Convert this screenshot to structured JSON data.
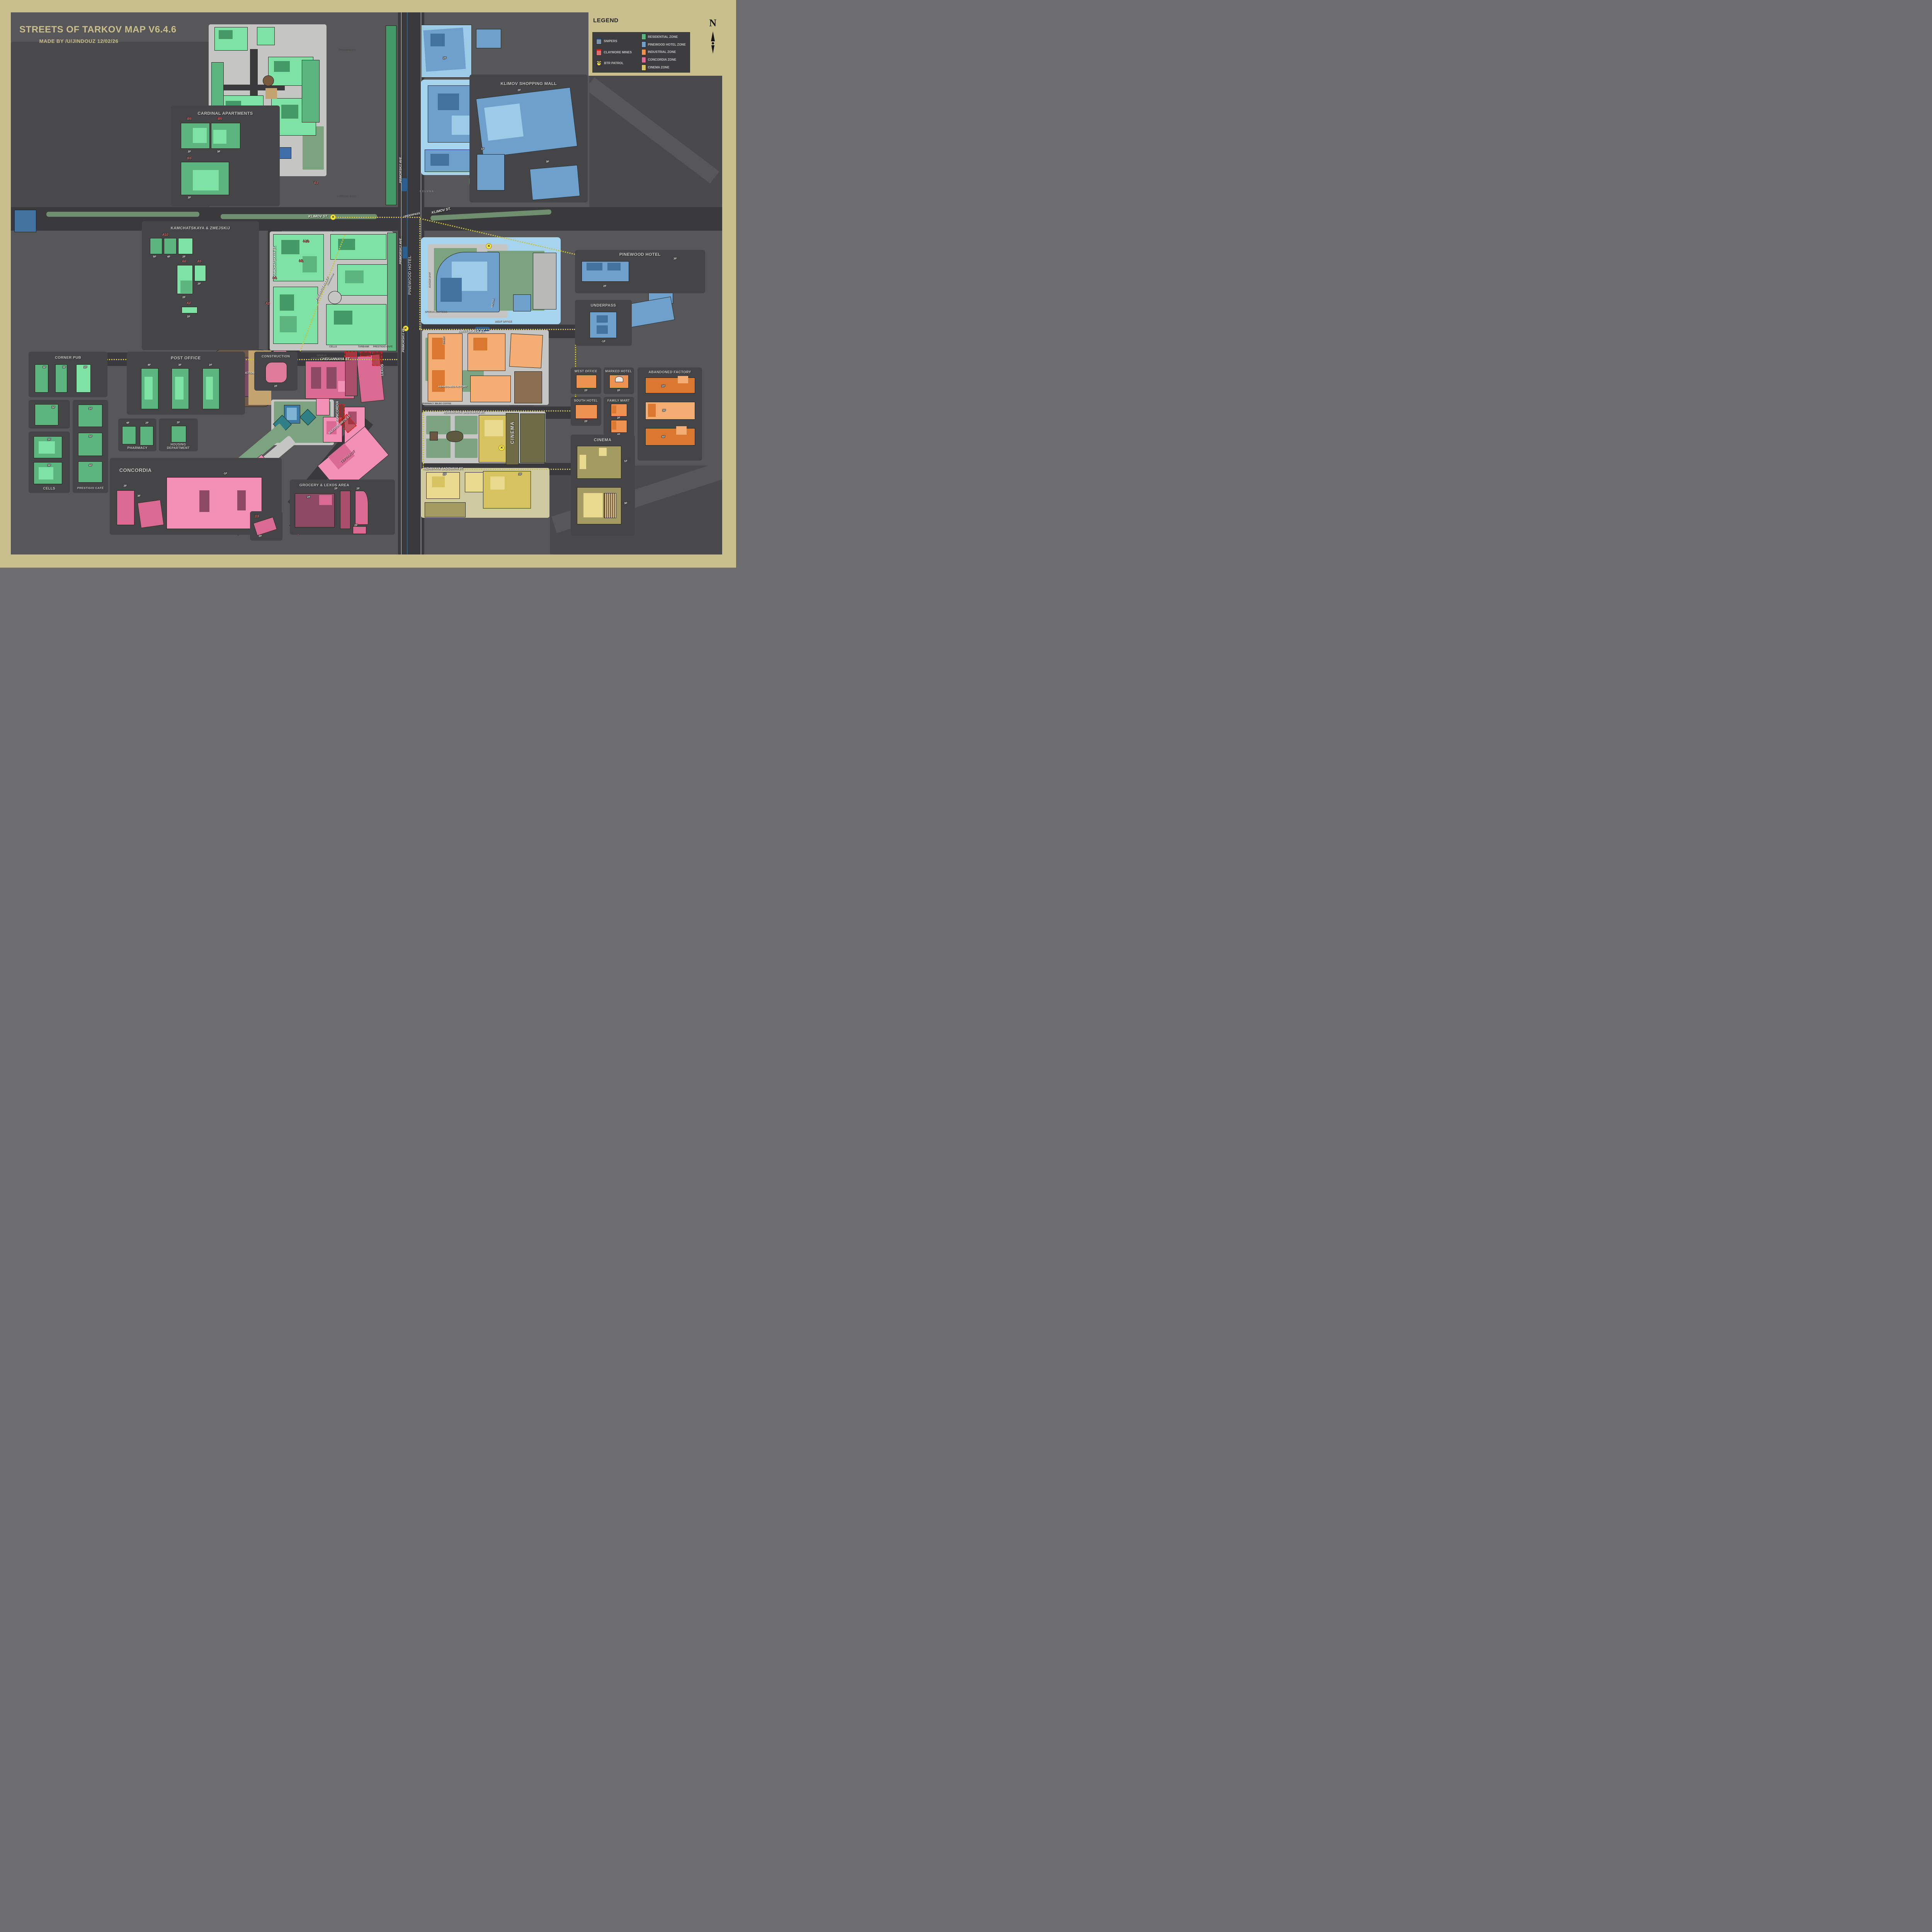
{
  "title": {
    "line1": "STREETS OF TARKOV MAP V6.4.6",
    "line2": "MADE BY /U/JINDOUZ 12/02/26"
  },
  "legend": {
    "title": "LEGEND",
    "markers": [
      {
        "icon": "snipers-icon",
        "label": "SNIPERS"
      },
      {
        "icon": "claymore-icon",
        "label": "CLAYMORE MINES"
      },
      {
        "icon": "btr-icon",
        "label": "BTR PATROL"
      }
    ],
    "zones": [
      {
        "label": "RESIDENTIAL ZONE",
        "color": "#57b57d"
      },
      {
        "label": "PINEWOOD HOTEL ZONE",
        "color": "#6f9fcb"
      },
      {
        "label": "INDUSTRIAL ZONE",
        "color": "#ed9250"
      },
      {
        "label": "CONCORDIA ZONE",
        "color": "#d96a92"
      },
      {
        "label": "CINEMA ZONE",
        "color": "#d6c25e"
      }
    ]
  },
  "compass": {
    "label": "N"
  },
  "streets": {
    "klimov": "KLIMOV ST.",
    "primorskij": "PRIMORSKIJ AVE.",
    "primorskij49": "PRIMORSKIJ 49",
    "nikitskaya": "NIKITSKAYA ST.",
    "chekannaya": "CHEKANNAYA ST.",
    "verhnyaya": "VERHNYAYA SADOVAYA ST.",
    "nizhnyaya": "NIZHNYAYA SADOVAYA ST.",
    "razvedchikov": "RAZVEDCHIKOV ST.",
    "kamchatskaya": "KAMCHATSKAYA ST.",
    "zmejskij": "ZMEJSKIJ ALLEY",
    "underpass": "UNDERPASS"
  },
  "map_labels": {
    "pharmacy3": "PHARMACY 3",
    "cardinal_apartments": "CARDINAL APARTMENTS",
    "cardinal_bank": "CARDINAL BANK",
    "lerm_expo": "LERM Expo",
    "klimov_mall": "KLIMOV SHOPPING MALL",
    "beluga": "BELUGA",
    "pinewood_hotel": "PINEWOOD HOTEL",
    "burger_spot": "BURGER SPOT",
    "sparja_express": "SPARJA EXPRESS",
    "nikita": "NIKITA",
    "west_office": "WEST OFFICE",
    "diner": "DINER",
    "abandoned_factory": "ABANDONED FACTORY",
    "pharmacy2": "PHARMACY 2",
    "bilbo_coffee": "BILBO COFFEE",
    "corner_restaurant": "CORNER RESTAURANT",
    "cinema": "CINEMA",
    "sparja_grocery": "SPARJA\nGROCERY STORE",
    "construction": "CONSTRUCTION",
    "concordia": "CONCORDIA",
    "lexos": "LEXOS",
    "terrakot": "ТЕРРАКОТ",
    "cells": "CELLS",
    "tarbank": "TARBANK",
    "prestigio_cafe": "PRESTIGIO CAFÉ",
    "corner_pub": "CORNER PUB"
  },
  "codes": {
    "b3": "B3",
    "a10": "A10",
    "a6": "A6",
    "a5": "A5",
    "a2": "A2",
    "d3": "D3"
  },
  "map_floors": [
    "2F",
    "2F",
    "2F"
  ],
  "panels": {
    "klimov_mall": {
      "title": "KLIMOV SHOPPING MALL",
      "floors": [
        "2F",
        "1F",
        "3F"
      ]
    },
    "cardinal": {
      "title": "CARDINAL APARTMENTS",
      "codes": [
        "B5",
        "B5",
        "B3"
      ],
      "floors": [
        "2F",
        "3F",
        "2F"
      ]
    },
    "kamchatskaya": {
      "title": "KAMCHATSKAYA & ZMEJSKIJ",
      "codes": [
        "A10",
        "A6",
        "A5",
        "A2"
      ],
      "floors": [
        "5F",
        "4F",
        "2F",
        "2F",
        "2F",
        "2F"
      ]
    },
    "corner_pub": {
      "title": "CORNER PUB",
      "floors": [
        "4F",
        "3F",
        "2F",
        "5F"
      ]
    },
    "cells": {
      "title": "CELLS",
      "floors": [
        "2F",
        "3F"
      ]
    },
    "prestigio": {
      "title": "PRESTIGIO CAFÉ",
      "floors": [
        "2F",
        "3F",
        "4F"
      ]
    },
    "post_office": {
      "title": "POST OFFICE",
      "floors": [
        "4F",
        "3F",
        "2F"
      ]
    },
    "pharmacy": {
      "title": "PHARMACY",
      "floors": [
        "4F",
        "2F"
      ]
    },
    "housing": {
      "title": "HOUSING\nDEPARTMENT",
      "floors": [
        "2F"
      ]
    },
    "construction": {
      "title": "CONSTRUCTION",
      "floors": [
        "2F"
      ]
    },
    "concordia": {
      "title": "CONCORDIA",
      "floors": [
        "-1F",
        "2F",
        "3F"
      ]
    },
    "grocery_lexos": {
      "title": "GROCERY & LEXOS AREA",
      "floors": [
        "2F",
        "2F",
        "2F",
        "2F"
      ]
    },
    "d3": {
      "floors": [
        "2F"
      ]
    },
    "pinewood": {
      "title": "PINEWOOD HOTEL",
      "floors": [
        "2F",
        "3F"
      ]
    },
    "underpass": {
      "title": "UNDERPASS",
      "floors": [
        "-1F"
      ]
    },
    "west_office": {
      "title": "WEST OFFICE",
      "floors": [
        "2F"
      ]
    },
    "marked_hotel": {
      "title": "MARKED HOTEL",
      "floors": [
        "2F"
      ]
    },
    "abandoned_factory": {
      "title": "ABANDONED FACTORY",
      "floors": [
        "2F",
        "3F",
        "4F"
      ]
    },
    "south_hotel": {
      "title": "SOUTH HOTEL",
      "floors": [
        "2F"
      ]
    },
    "family_mart": {
      "title": "FAMILY MART",
      "floors": [
        "2F",
        "4F"
      ]
    },
    "cinema": {
      "title": "CINEMA",
      "floors": [
        "1F",
        "3F"
      ]
    }
  }
}
